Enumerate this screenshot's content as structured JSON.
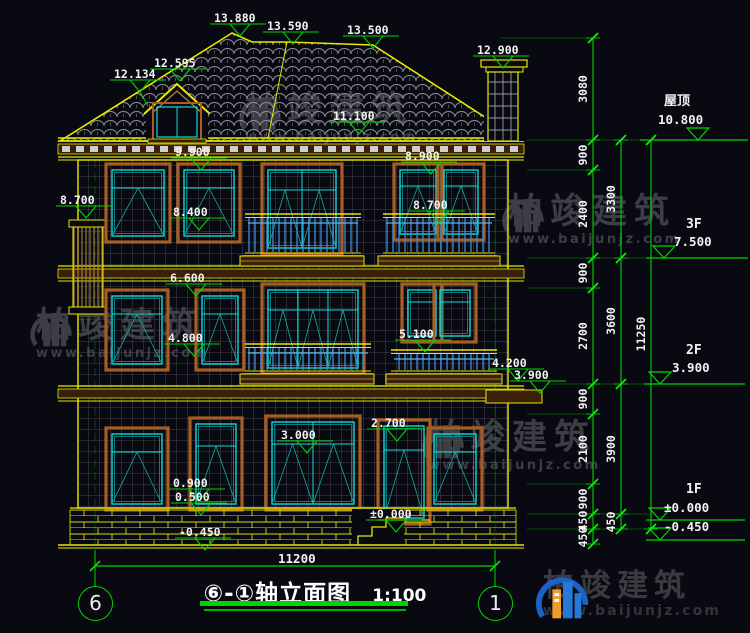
{
  "title": {
    "text": "⑥-①轴立面图",
    "scale": "1:100"
  },
  "axes": {
    "left": "6",
    "right": "1"
  },
  "bottom_dimension": {
    "text": "11200"
  },
  "annotations": [
    {
      "text": "13.880",
      "x": 214,
      "y": 12
    },
    {
      "text": "13.590",
      "x": 267,
      "y": 20
    },
    {
      "text": "13.500",
      "x": 347,
      "y": 24
    },
    {
      "text": "12.595",
      "x": 154,
      "y": 57
    },
    {
      "text": "12.134",
      "x": 114,
      "y": 68
    },
    {
      "text": "12.900",
      "x": 477,
      "y": 44
    },
    {
      "text": "11.100",
      "x": 333,
      "y": 110
    },
    {
      "text": "9.900",
      "x": 175,
      "y": 146
    },
    {
      "text": "8.900",
      "x": 405,
      "y": 150
    },
    {
      "text": "8.700",
      "x": 60,
      "y": 194
    },
    {
      "text": "8.400",
      "x": 173,
      "y": 206
    },
    {
      "text": "8.700",
      "x": 413,
      "y": 199
    },
    {
      "text": "6.600",
      "x": 170,
      "y": 272
    },
    {
      "text": "4.800",
      "x": 168,
      "y": 332
    },
    {
      "text": "5.100",
      "x": 399,
      "y": 328
    },
    {
      "text": "4.200",
      "x": 492,
      "y": 357
    },
    {
      "text": "3.900",
      "x": 514,
      "y": 369
    },
    {
      "text": "3.000",
      "x": 281,
      "y": 429
    },
    {
      "text": "2.700",
      "x": 371,
      "y": 417
    },
    {
      "text": "0.900",
      "x": 173,
      "y": 477
    },
    {
      "text": "0.500",
      "x": 175,
      "y": 491
    },
    {
      "text": "±0.000",
      "x": 370,
      "y": 508
    },
    {
      "text": "-0.450",
      "x": 179,
      "y": 526
    }
  ],
  "levels": [
    {
      "name": "屋顶",
      "value": "10.800",
      "tx": 664,
      "ty": 96,
      "vx": 658,
      "vy": 114,
      "ly": 140,
      "cx": 698,
      "x1": 640,
      "x2": 748
    },
    {
      "name": "3F",
      "value": "7.500",
      "tx": 686,
      "ty": 219,
      "vx": 674,
      "vy": 236,
      "ly": 258,
      "cx": 664,
      "x1": 646,
      "x2": 748
    },
    {
      "name": "2F",
      "value": "3.900",
      "tx": 686,
      "ty": 345,
      "vx": 672,
      "vy": 362,
      "ly": 384,
      "cx": 660,
      "x1": 644,
      "x2": 745
    },
    {
      "name": "1F",
      "value": "±0.000",
      "tx": 686,
      "ty": 484,
      "vx": 664,
      "vy": 502,
      "ly": 520,
      "cx": 660,
      "x1": 646,
      "x2": 745
    },
    {
      "name": "",
      "value": "-0.450",
      "tx": 0,
      "ty": 0,
      "vx": 664,
      "vy": 521,
      "ly": 540,
      "cx": 660,
      "x1": 646,
      "x2": 745
    }
  ],
  "dimension_chains": [
    {
      "x": 593,
      "ticks": [
        38,
        140,
        170,
        258,
        288,
        384,
        414,
        484,
        514,
        529,
        544
      ],
      "labels": [
        {
          "text": "3080",
          "cy": 89
        },
        {
          "text": "900",
          "cy": 155
        },
        {
          "text": "2400",
          "cy": 214
        },
        {
          "text": "900",
          "cy": 273
        },
        {
          "text": "2700",
          "cy": 336
        },
        {
          "text": "900",
          "cy": 399
        },
        {
          "text": "2100",
          "cy": 449
        },
        {
          "text": "900",
          "cy": 499
        },
        {
          "text": "450",
          "cy": 521
        },
        {
          "text": "450",
          "cy": 537
        }
      ]
    },
    {
      "x": 621,
      "ticks": [
        140,
        258,
        384,
        514,
        529
      ],
      "labels": [
        {
          "text": "3300",
          "cy": 199
        },
        {
          "text": "3600",
          "cy": 321
        },
        {
          "text": "3900",
          "cy": 449
        },
        {
          "text": "450",
          "cy": 522
        }
      ]
    },
    {
      "x": 651,
      "ticks": [
        140,
        529
      ],
      "labels": [
        {
          "text": "11250",
          "cy": 334
        }
      ]
    }
  ],
  "watermark_brand": {
    "name": "柏竣建筑",
    "url": "www.baijunjz.com"
  },
  "colors": {
    "background": "#090911",
    "dimension_green": "#00d400",
    "line_yellow": "#e8e800",
    "window_cyan": "#15d8d8",
    "trim_brown": "#a85e22",
    "railing_blue": "#3c8cdc",
    "text_white": "#f2f2f2",
    "watermark_gray": "#45454d",
    "logo_blue": "#1a62c8",
    "logo_orange": "#f09c28"
  }
}
